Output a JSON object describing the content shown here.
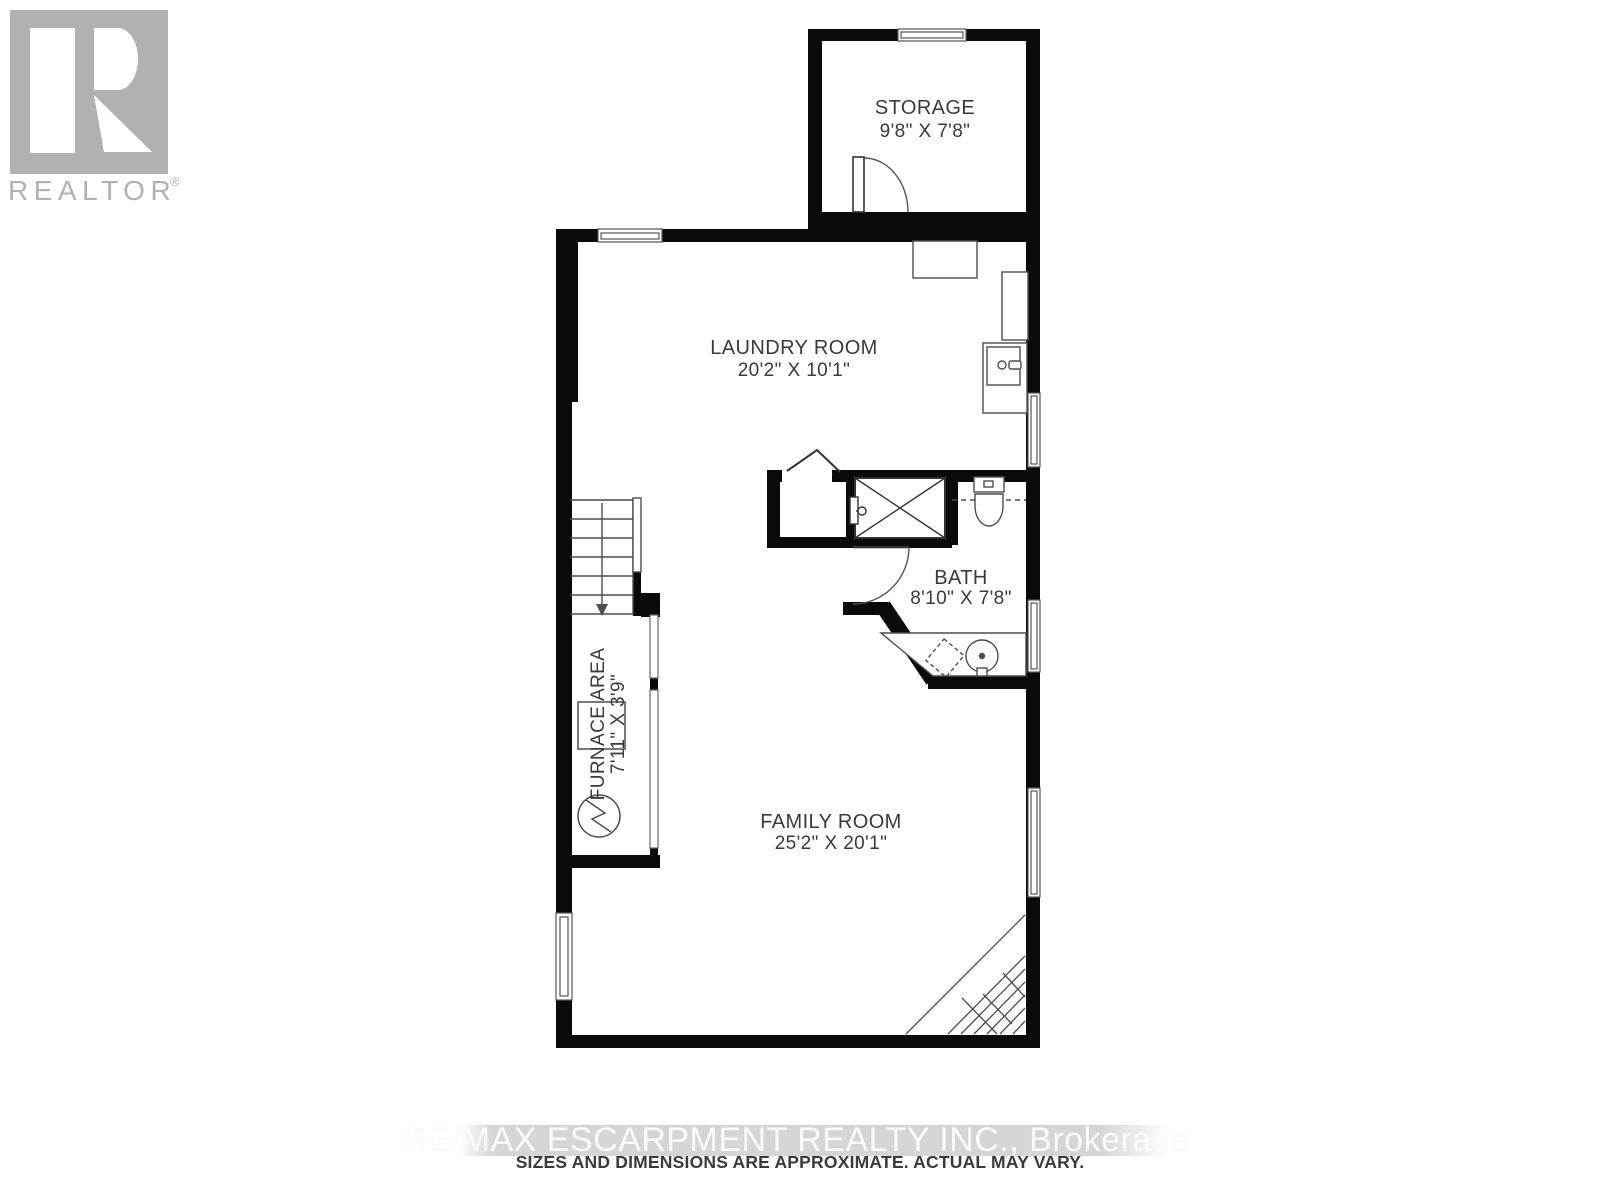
{
  "branding": {
    "logo_text": "REALTOR",
    "logo_reg": "®"
  },
  "rooms": {
    "storage": {
      "name": "STORAGE",
      "dims": "9'8\" X 7'8\""
    },
    "laundry": {
      "name": "LAUNDRY ROOM",
      "dims": "20'2\" X 10'1\""
    },
    "bath": {
      "name": "BATH",
      "dims": "8'10\" X 7'8\""
    },
    "furnace": {
      "name": "FURNACE AREA",
      "dims": "7'11\" X 3'9\""
    },
    "family": {
      "name": "FAMILY ROOM",
      "dims": "25'2\" X 20'1\""
    }
  },
  "footer": {
    "watermark": "RE/MAX ESCARPMENT REALTY INC.,  Brokerage",
    "disclaimer": "SIZES AND DIMENSIONS ARE APPROXIMATE. ACTUAL MAY VARY."
  },
  "colors": {
    "wall": "#0a0a0a",
    "fixture_line": "#4d4d4d",
    "label": "#3a3a3a",
    "logo_gray": "#b1b1b1",
    "watermark_band": "#d0d0d0",
    "watermark_text": "#fafafa"
  }
}
